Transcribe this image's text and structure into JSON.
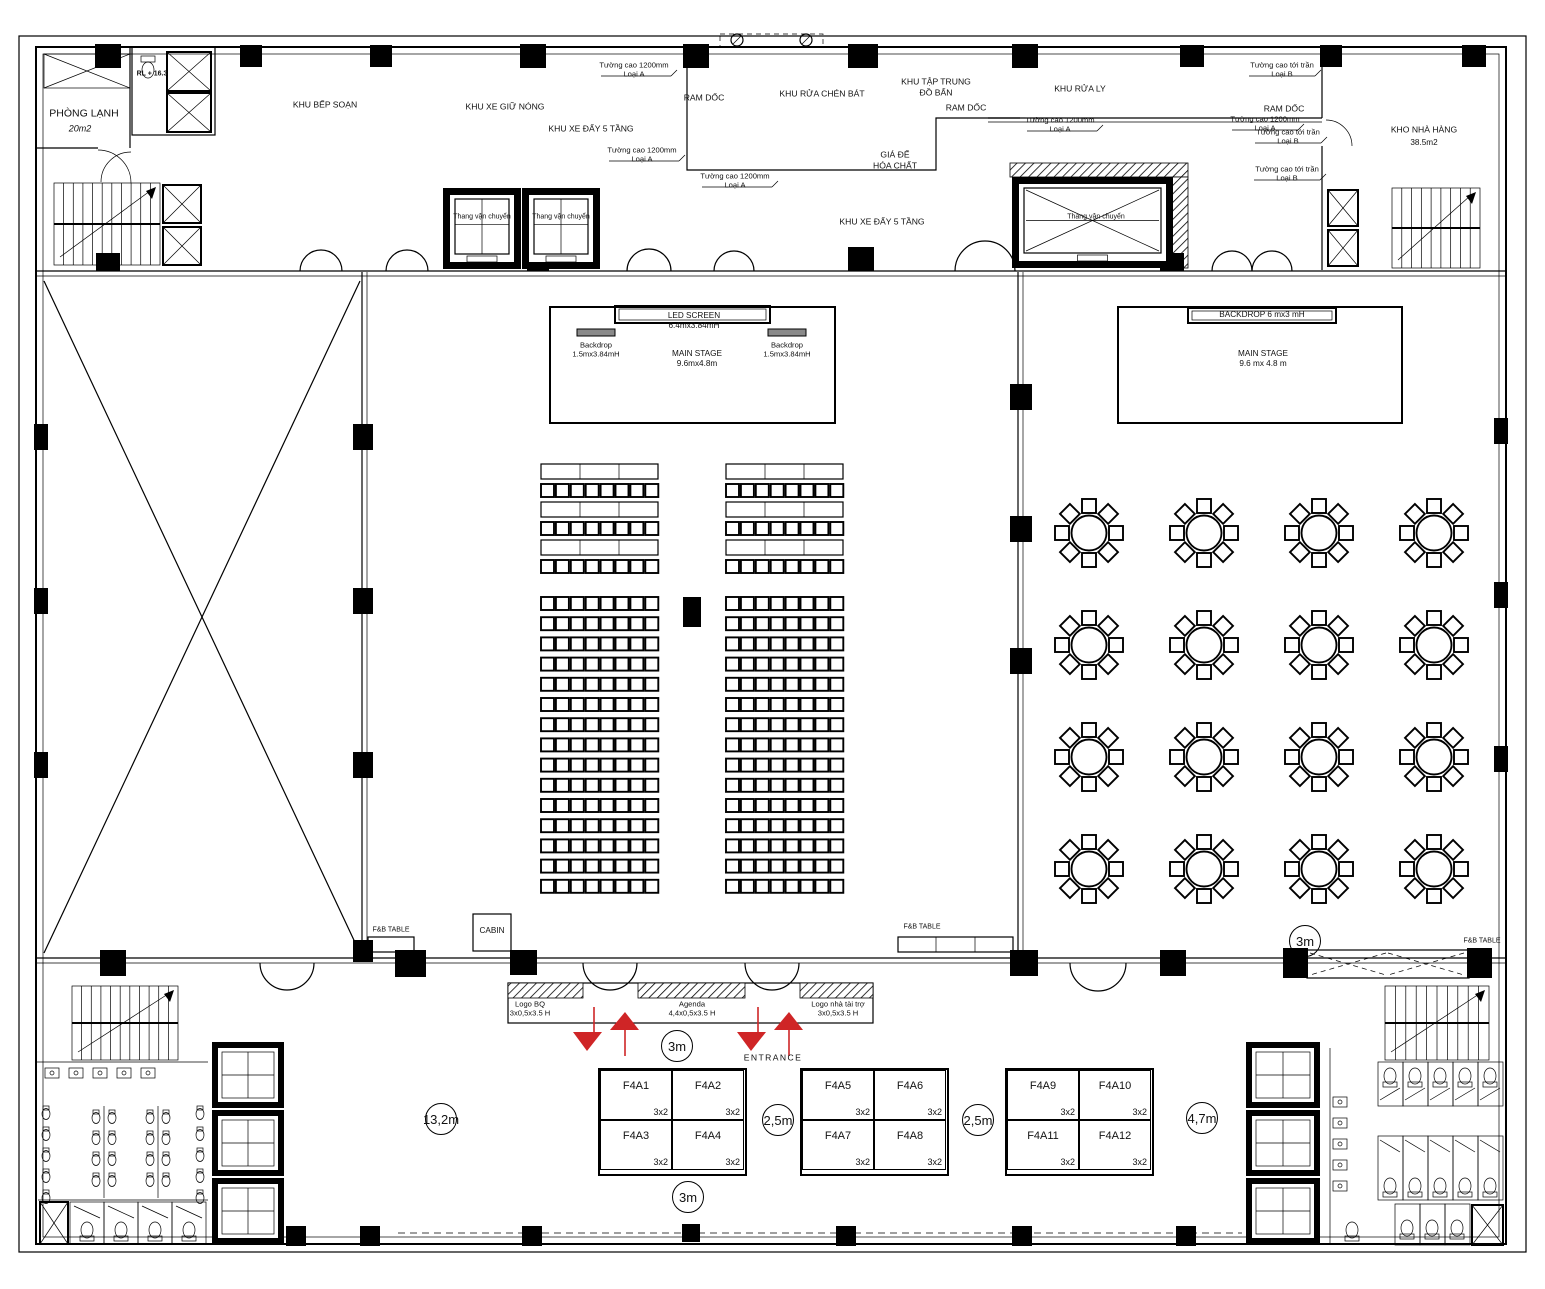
{
  "plan": {
    "rooms": {
      "phong_lanh": "PHÒNG LẠNH",
      "phong_lanh_area": "20m2",
      "rl_level": "RL + 16.3",
      "khu_bep_soan": "KHU BẾP SOẠN",
      "khu_xe_giu_nong": "KHU XE GIỮ NÓNG",
      "khu_xe_day": "KHU XE ĐẨY 5 TẦNG",
      "ram_doc": "RAM DỐC",
      "khu_rua_chen_bat": "KHU RỬA CHÉN BÁT",
      "khu_tap_trung": "KHU TẬP TRUNG\nĐỒ BẨN",
      "gia_de_hoa_chat": "GIÁ ĐỂ\nHÓA CHẤT",
      "khu_rua_ly": "KHU RỬA LY",
      "kho_nha_hang": "KHO NHÀ HÀNG",
      "kho_nha_hang_area": "38.5m2",
      "thang_van_chuyen": "Thang vận chuyển"
    },
    "annotations": {
      "wall_1200": "Tường cao 1200mm\nLoại A",
      "wall_ceiling": "Tường cao tới trần\nLoại B"
    },
    "stage_left": {
      "led": "LED SCREEN\n6.4mx3.84mH",
      "backdrop": "Backdrop\n1.5mx3.84mH",
      "main": "MAIN STAGE\n9.6mx4.8m"
    },
    "stage_right": {
      "backdrop": "BACKDROP 6 mx3 mH",
      "main": "MAIN STAGE\n9.6 mx 4.8 m"
    },
    "entrance_band": {
      "logo_bq": "Logo BQ\n3x0,5x3.5 H",
      "agenda": "Agenda\n4,4x0,5x3.5 H",
      "logo_sponsor": "Logo nhà tài trợ\n3x0,5x3.5 H"
    },
    "entrance_label": "ENTRANCE",
    "cabin": "CABIN",
    "fnb_table": "F&B TABLE",
    "dimensions": {
      "lobby_left": "13,2m",
      "booth_gap": "2,5m",
      "lobby_right": "4,7m",
      "aisle": "3m"
    },
    "booths": [
      {
        "id": "F4A1",
        "size": "3x2"
      },
      {
        "id": "F4A2",
        "size": "3x2"
      },
      {
        "id": "F4A3",
        "size": "3x2"
      },
      {
        "id": "F4A4",
        "size": "3x2"
      },
      {
        "id": "F4A5",
        "size": "3x2"
      },
      {
        "id": "F4A6",
        "size": "3x2"
      },
      {
        "id": "F4A7",
        "size": "3x2"
      },
      {
        "id": "F4A8",
        "size": "3x2"
      },
      {
        "id": "F4A9",
        "size": "3x2"
      },
      {
        "id": "F4A10",
        "size": "3x2"
      },
      {
        "id": "F4A11",
        "size": "3x2"
      },
      {
        "id": "F4A12",
        "size": "3x2"
      }
    ],
    "furniture": {
      "theater_seating": {
        "blocks": 2,
        "head_table_rows": 3,
        "chair_rows": 15,
        "chairs_per_row": 8
      },
      "banquet_tables": {
        "rows": 4,
        "cols": 4,
        "seats_per_table": 8
      }
    },
    "colors": {
      "accent_red": "#cf2526",
      "line": "#000000"
    }
  }
}
